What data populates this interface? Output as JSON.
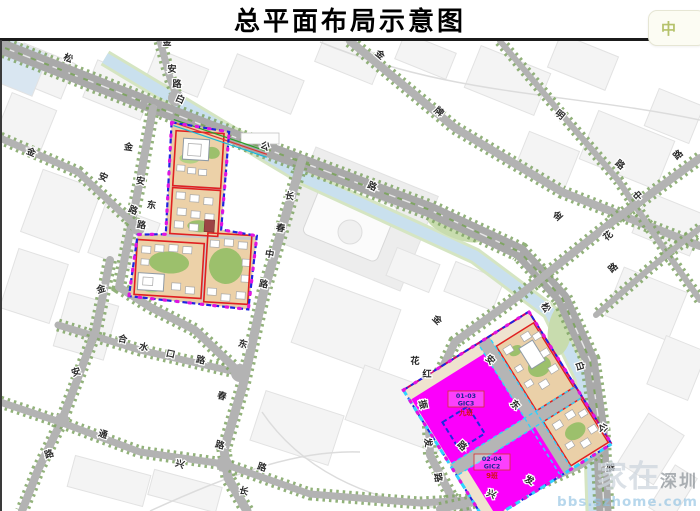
{
  "title": "总平面布局示意图",
  "ime_chip": {
    "label": "中"
  },
  "watermark": {
    "brand": "家在",
    "city": "深圳",
    "url": "bbs.szhome.com"
  },
  "legend_colors": {
    "site_boundary_blue": "#1d24e0",
    "boundary_dot_magenta": "#e014e0",
    "parcel_outline_red": "#e02020",
    "gic_parcel_magenta": "#fb00fb",
    "boundary_cyan": "#2fd2ff",
    "boundary_crimson": "#d0006e",
    "river_blue": "#c9e0ee",
    "road_gray": "#b3b3b3",
    "tree_green": "#7fa463",
    "site_ground_tan": "#e9cda6"
  },
  "sites": {
    "southeast": {
      "parcels": [
        {
          "id": "01-03",
          "code": "GIC3",
          "note": "九班"
        },
        {
          "id": "02-04",
          "code": "GIC2",
          "note": "9班"
        }
      ]
    }
  },
  "road_labels": [
    {
      "name": "松白公路",
      "chars": [
        {
          "t": "松",
          "x": 67,
          "y": 61,
          "r": 24
        },
        {
          "t": "白",
          "x": 179,
          "y": 102,
          "r": 24
        },
        {
          "t": "公",
          "x": 264,
          "y": 149,
          "r": 24
        },
        {
          "t": "路",
          "x": 371,
          "y": 189,
          "r": 24
        }
      ]
    },
    {
      "name": "松白公路南段",
      "chars": [
        {
          "t": "松",
          "x": 543,
          "y": 309,
          "r": 60
        },
        {
          "t": "白",
          "x": 577,
          "y": 367,
          "r": 72
        },
        {
          "t": "公",
          "x": 600,
          "y": 428,
          "r": 82
        },
        {
          "t": "路",
          "x": 607,
          "y": 468,
          "r": 85
        }
      ]
    },
    {
      "name": "金安路北",
      "chars": [
        {
          "t": "金",
          "x": 167,
          "y": 45,
          "r": 0
        },
        {
          "t": "安",
          "x": 172,
          "y": 72,
          "r": 0
        },
        {
          "t": "路",
          "x": 177,
          "y": 87,
          "r": 0
        }
      ]
    },
    {
      "name": "金牌路",
      "chars": [
        {
          "t": "金",
          "x": 378,
          "y": 57,
          "r": 40
        },
        {
          "t": "牌",
          "x": 437,
          "y": 114,
          "r": 40
        }
      ]
    },
    {
      "name": "明路",
      "chars": [
        {
          "t": "明",
          "x": 558,
          "y": 117,
          "r": 40
        },
        {
          "t": "路",
          "x": 618,
          "y": 167,
          "r": 40
        }
      ]
    },
    {
      "name": "中路",
      "chars": [
        {
          "t": "中",
          "x": 640,
          "y": 198,
          "r": -42
        },
        {
          "t": "路",
          "x": 680,
          "y": 157,
          "r": -42
        }
      ]
    },
    {
      "name": "金花路",
      "chars": [
        {
          "t": "金",
          "x": 560,
          "y": 218,
          "r": -42
        },
        {
          "t": "花",
          "x": 610,
          "y": 238,
          "r": -42
        },
        {
          "t": "路",
          "x": 615,
          "y": 270,
          "r": -42
        }
      ]
    },
    {
      "name": "金安路西",
      "chars": [
        {
          "t": "金",
          "x": 30,
          "y": 155,
          "r": 22
        },
        {
          "t": "安",
          "x": 102,
          "y": 180,
          "r": 22
        },
        {
          "t": "路",
          "x": 132,
          "y": 213,
          "r": 22
        }
      ]
    },
    {
      "name": "金安东路",
      "chars": [
        {
          "t": "金",
          "x": 128,
          "y": 150,
          "r": 8
        },
        {
          "t": "安",
          "x": 140,
          "y": 184,
          "r": 8
        },
        {
          "t": "东",
          "x": 151,
          "y": 208,
          "r": 8
        },
        {
          "t": "路",
          "x": 141,
          "y": 228,
          "r": 8
        }
      ]
    },
    {
      "name": "长春中路",
      "chars": [
        {
          "t": "长",
          "x": 289,
          "y": 199,
          "r": 10
        },
        {
          "t": "春",
          "x": 280,
          "y": 231,
          "r": 10
        },
        {
          "t": "中",
          "x": 269,
          "y": 257,
          "r": 10
        },
        {
          "t": "路",
          "x": 263,
          "y": 287,
          "r": 10
        }
      ]
    },
    {
      "name": "长春路南",
      "chars": [
        {
          "t": "东",
          "x": 242,
          "y": 347,
          "r": 15
        },
        {
          "t": "春",
          "x": 221,
          "y": 399,
          "r": 15
        },
        {
          "t": "路",
          "x": 219,
          "y": 448,
          "r": 15
        },
        {
          "t": "长",
          "x": 243,
          "y": 494,
          "r": 15
        }
      ]
    },
    {
      "name": "合水口路",
      "chars": [
        {
          "t": "合",
          "x": 122,
          "y": 342,
          "r": 12
        },
        {
          "t": "水",
          "x": 143,
          "y": 350,
          "r": 12
        },
        {
          "t": "口",
          "x": 170,
          "y": 357,
          "r": 12
        },
        {
          "t": "路",
          "x": 200,
          "y": 363,
          "r": 12
        }
      ]
    },
    {
      "name": "金安路西南",
      "chars": [
        {
          "t": "金",
          "x": 102,
          "y": 292,
          "r": -18
        },
        {
          "t": "安",
          "x": 77,
          "y": 375,
          "r": -18
        },
        {
          "t": "路",
          "x": 50,
          "y": 457,
          "r": -18
        }
      ]
    },
    {
      "name": "通兴路",
      "chars": [
        {
          "t": "通",
          "x": 102,
          "y": 437,
          "r": 18
        },
        {
          "t": "兴",
          "x": 179,
          "y": 467,
          "r": 18
        },
        {
          "t": "路",
          "x": 261,
          "y": 470,
          "r": 18
        }
      ]
    },
    {
      "name": "振发路",
      "chars": [
        {
          "t": "振",
          "x": 420,
          "y": 405,
          "r": 78
        },
        {
          "t": "发",
          "x": 425,
          "y": 443,
          "r": 80
        },
        {
          "t": "路",
          "x": 435,
          "y": 478,
          "r": 80
        }
      ]
    },
    {
      "name": "安东路内",
      "chars": [
        {
          "t": "金",
          "x": 435,
          "y": 322,
          "r": 45
        },
        {
          "t": "安",
          "x": 488,
          "y": 362,
          "r": 45
        },
        {
          "t": "东",
          "x": 513,
          "y": 407,
          "r": 45
        },
        {
          "t": "路",
          "x": 460,
          "y": 448,
          "r": 45
        }
      ]
    },
    {
      "name": "红花路",
      "chars": [
        {
          "t": "花",
          "x": 415,
          "y": 364,
          "r": 0
        },
        {
          "t": "红",
          "x": 427,
          "y": 377,
          "r": 0
        }
      ]
    },
    {
      "name": "兴发路",
      "chars": [
        {
          "t": "兴",
          "x": 490,
          "y": 497,
          "r": 25
        },
        {
          "t": "发",
          "x": 528,
          "y": 483,
          "r": 25
        }
      ]
    }
  ]
}
